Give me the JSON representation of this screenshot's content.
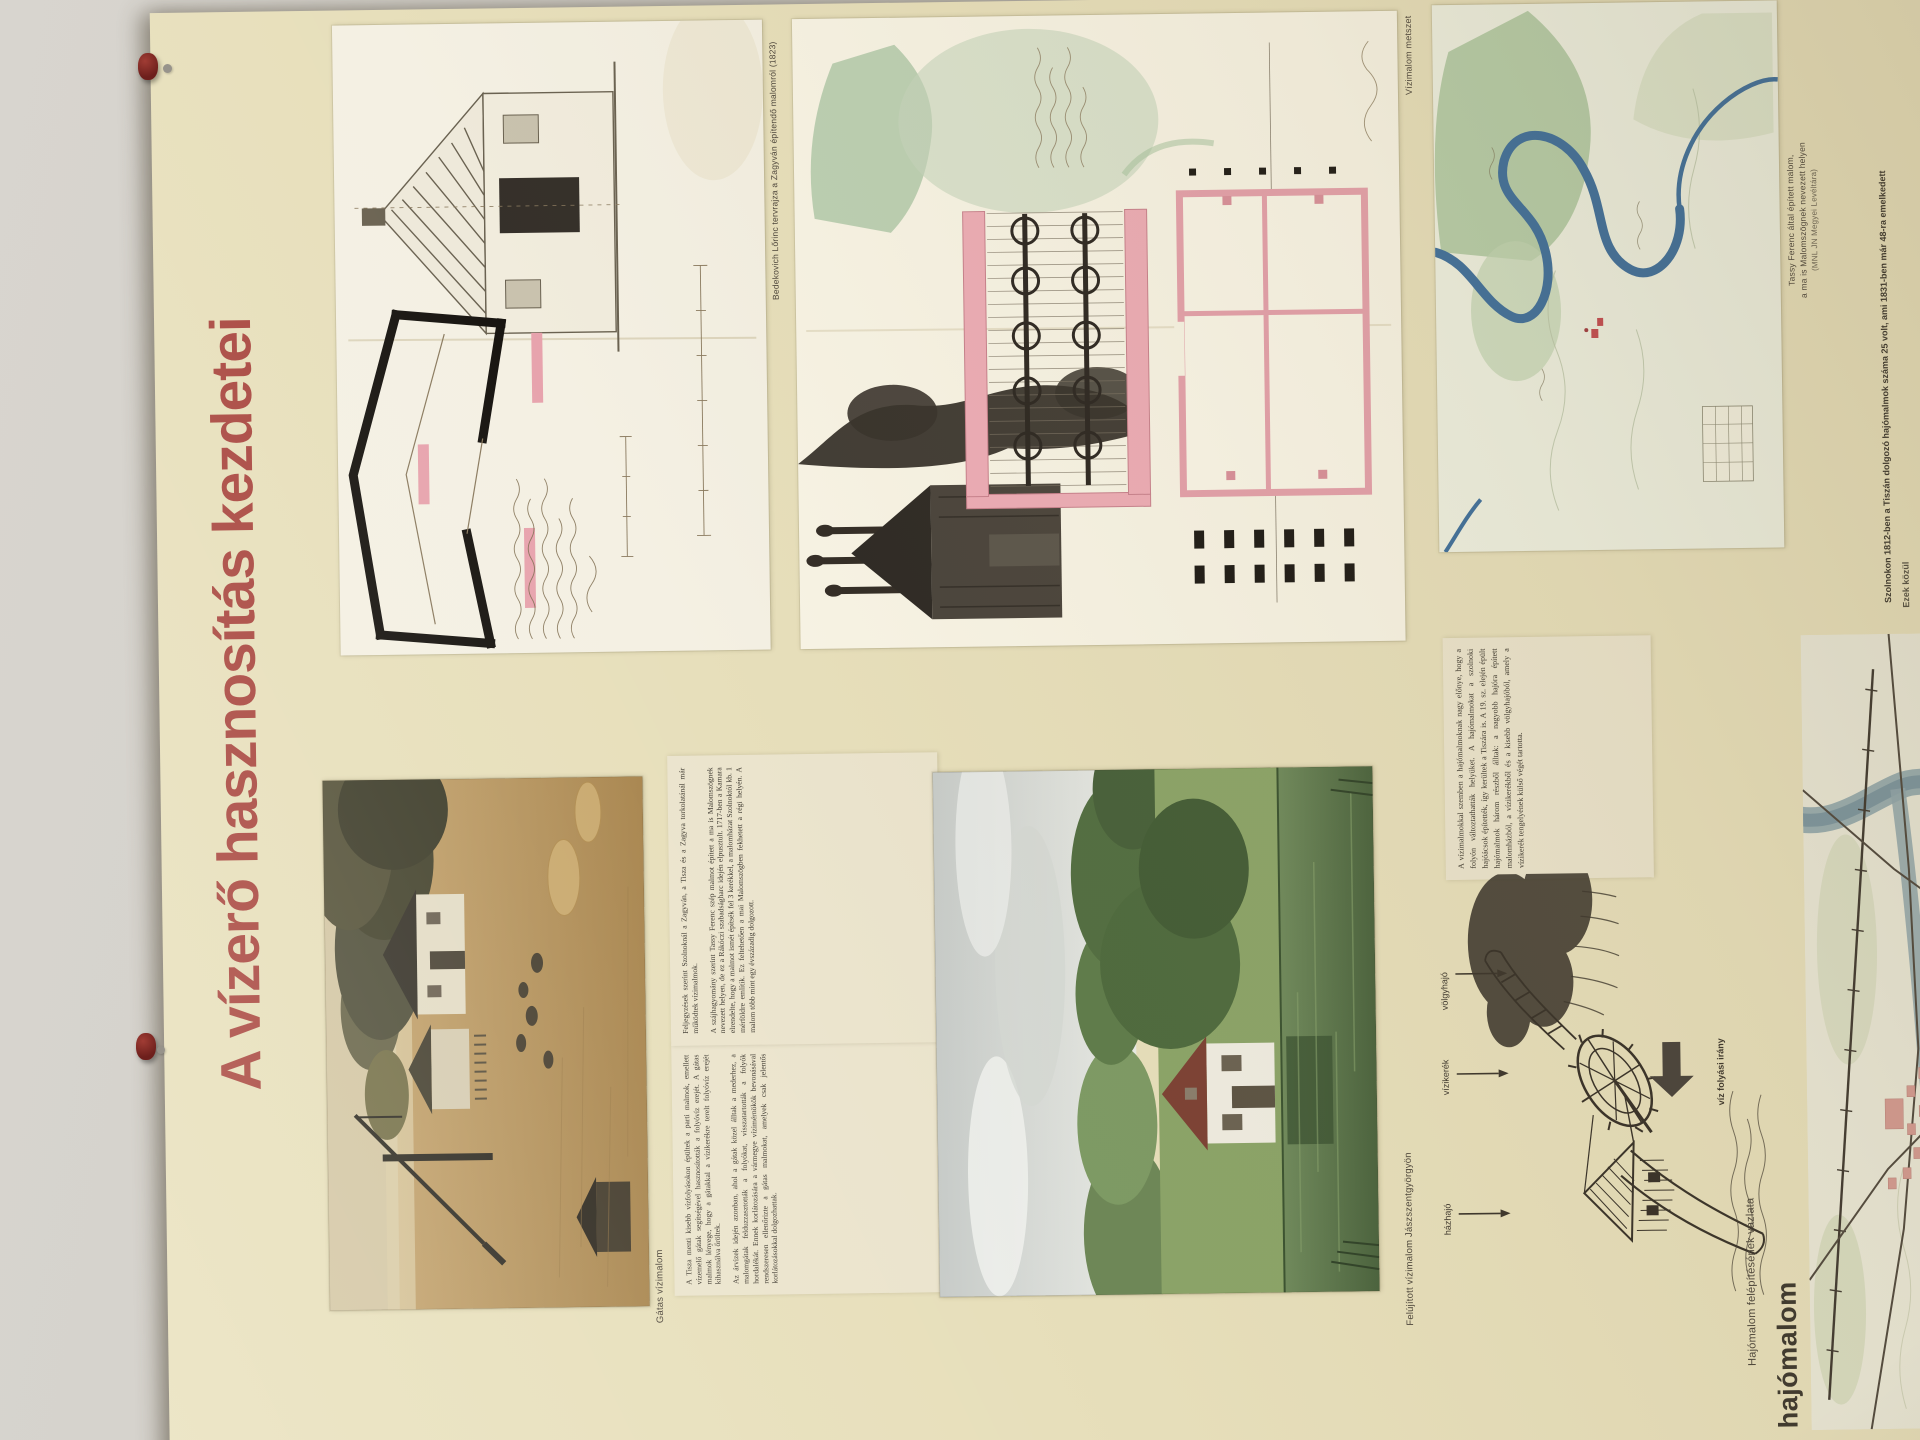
{
  "poster": {
    "title": "A vízerő hasznosítás kezdetei",
    "colors": {
      "background": "#e7dfbb",
      "title_red": "#a8453e",
      "ink": "#3c372e",
      "caption": "#4b443a",
      "watercolor_pink": "#e5a2ac",
      "watercolor_green": "#b2c9aa",
      "river_blue": "#3d6e9c",
      "pin_red": "#7c2420"
    },
    "captions": {
      "plan_drawing": "Bedekovich Lőrinc tervrajza a Zagyván építendő malomról (1823)",
      "mill_section": "Vízimalom metszet",
      "river_map_line1": "Tassy Ferenc által épített malom,",
      "river_map_line2": "a ma is Malomszögnek nevezett helyen",
      "river_map_line3": "(MNL JN Megyei Levéltára)",
      "rural_photo": "Gátas vízimalom",
      "pond_photo": "Felújított vízimalom Jászszentgyörgyön",
      "ship_mill_sketch": "Hajómalom felépítésének vázlata"
    },
    "diagram_labels": {
      "house_boat": "házhajó",
      "water_wheel": "vízikerék",
      "valley_boat": "völgyhajó",
      "flow_direction": "víz folyási irány"
    },
    "section_heading": "hajómalom",
    "stat_line": "Szolnokon 1812-ben a Tiszán dolgozó hajómalmok száma 25 volt, ami 1831-ben már 48-ra emelkedett",
    "stat_line_fragment": "Ezek közül",
    "paragraphs": {
      "col1_p1": "A Tisza menti kisebb vízfolyásokon épültek a parti malmok, emellett vízemelő gátak segítségével hasznosították a folyóvíz erejét. A gátas malmok lényege, hogy a gátakkal a vízikerékre terelt folyóvíz erejét kihasználva őröltek.",
      "col1_p2": "Az árvizek idején azonban, ahol a gátak közel álltak a mederhez, a malomgátak felduzzasztották a folyókat, visszatartották a folyók hordalékát. Ennek korlátozására a vármegye vízimérnökök bevonásával rendszeresen ellenőrizte a gátas malmokat, amelyek csak jelentős korlátozásokkal dolgozhattak.",
      "col2_p1": "Feljegyzések szerint Szolnoknál a Zagyván, a Tisza és a Zagyva torkolatánál már működtek vízimalmok.",
      "col2_p2": "A szájhagyomány szerint Tassy Ferenc szép malmot épített a ma is Malomszögnek nevezett helyen, de ez a Rákóczi szabadságharc idején elpusztult. 1717-ben a Kamara elrendelte, hogy a malmot ismét építsék fel 3 kerékkel, a malomházat Szolnoktól kb. 1 mérföldre említik. Ez feltehetően a mai Malomszögben fekhetett a régi helyén. A malom több mint egy évszázadig dolgozott.",
      "ship_intro": "A vízimalmokkal szemben a hajómalmoknak nagy előnye, hogy a folyón változtathatták helyüket. A hajómalmokat a szolnoki hajóácsok építették, így kerültek a Tiszára is. A 19. sz. elején épült hajómalmok három részből álltak: a nagyobb hajóra épített malomházból, a vízikerékből és a kisebb völgyhajóból, amely a vízikerék tengelyének külső végét tartotta."
    }
  }
}
